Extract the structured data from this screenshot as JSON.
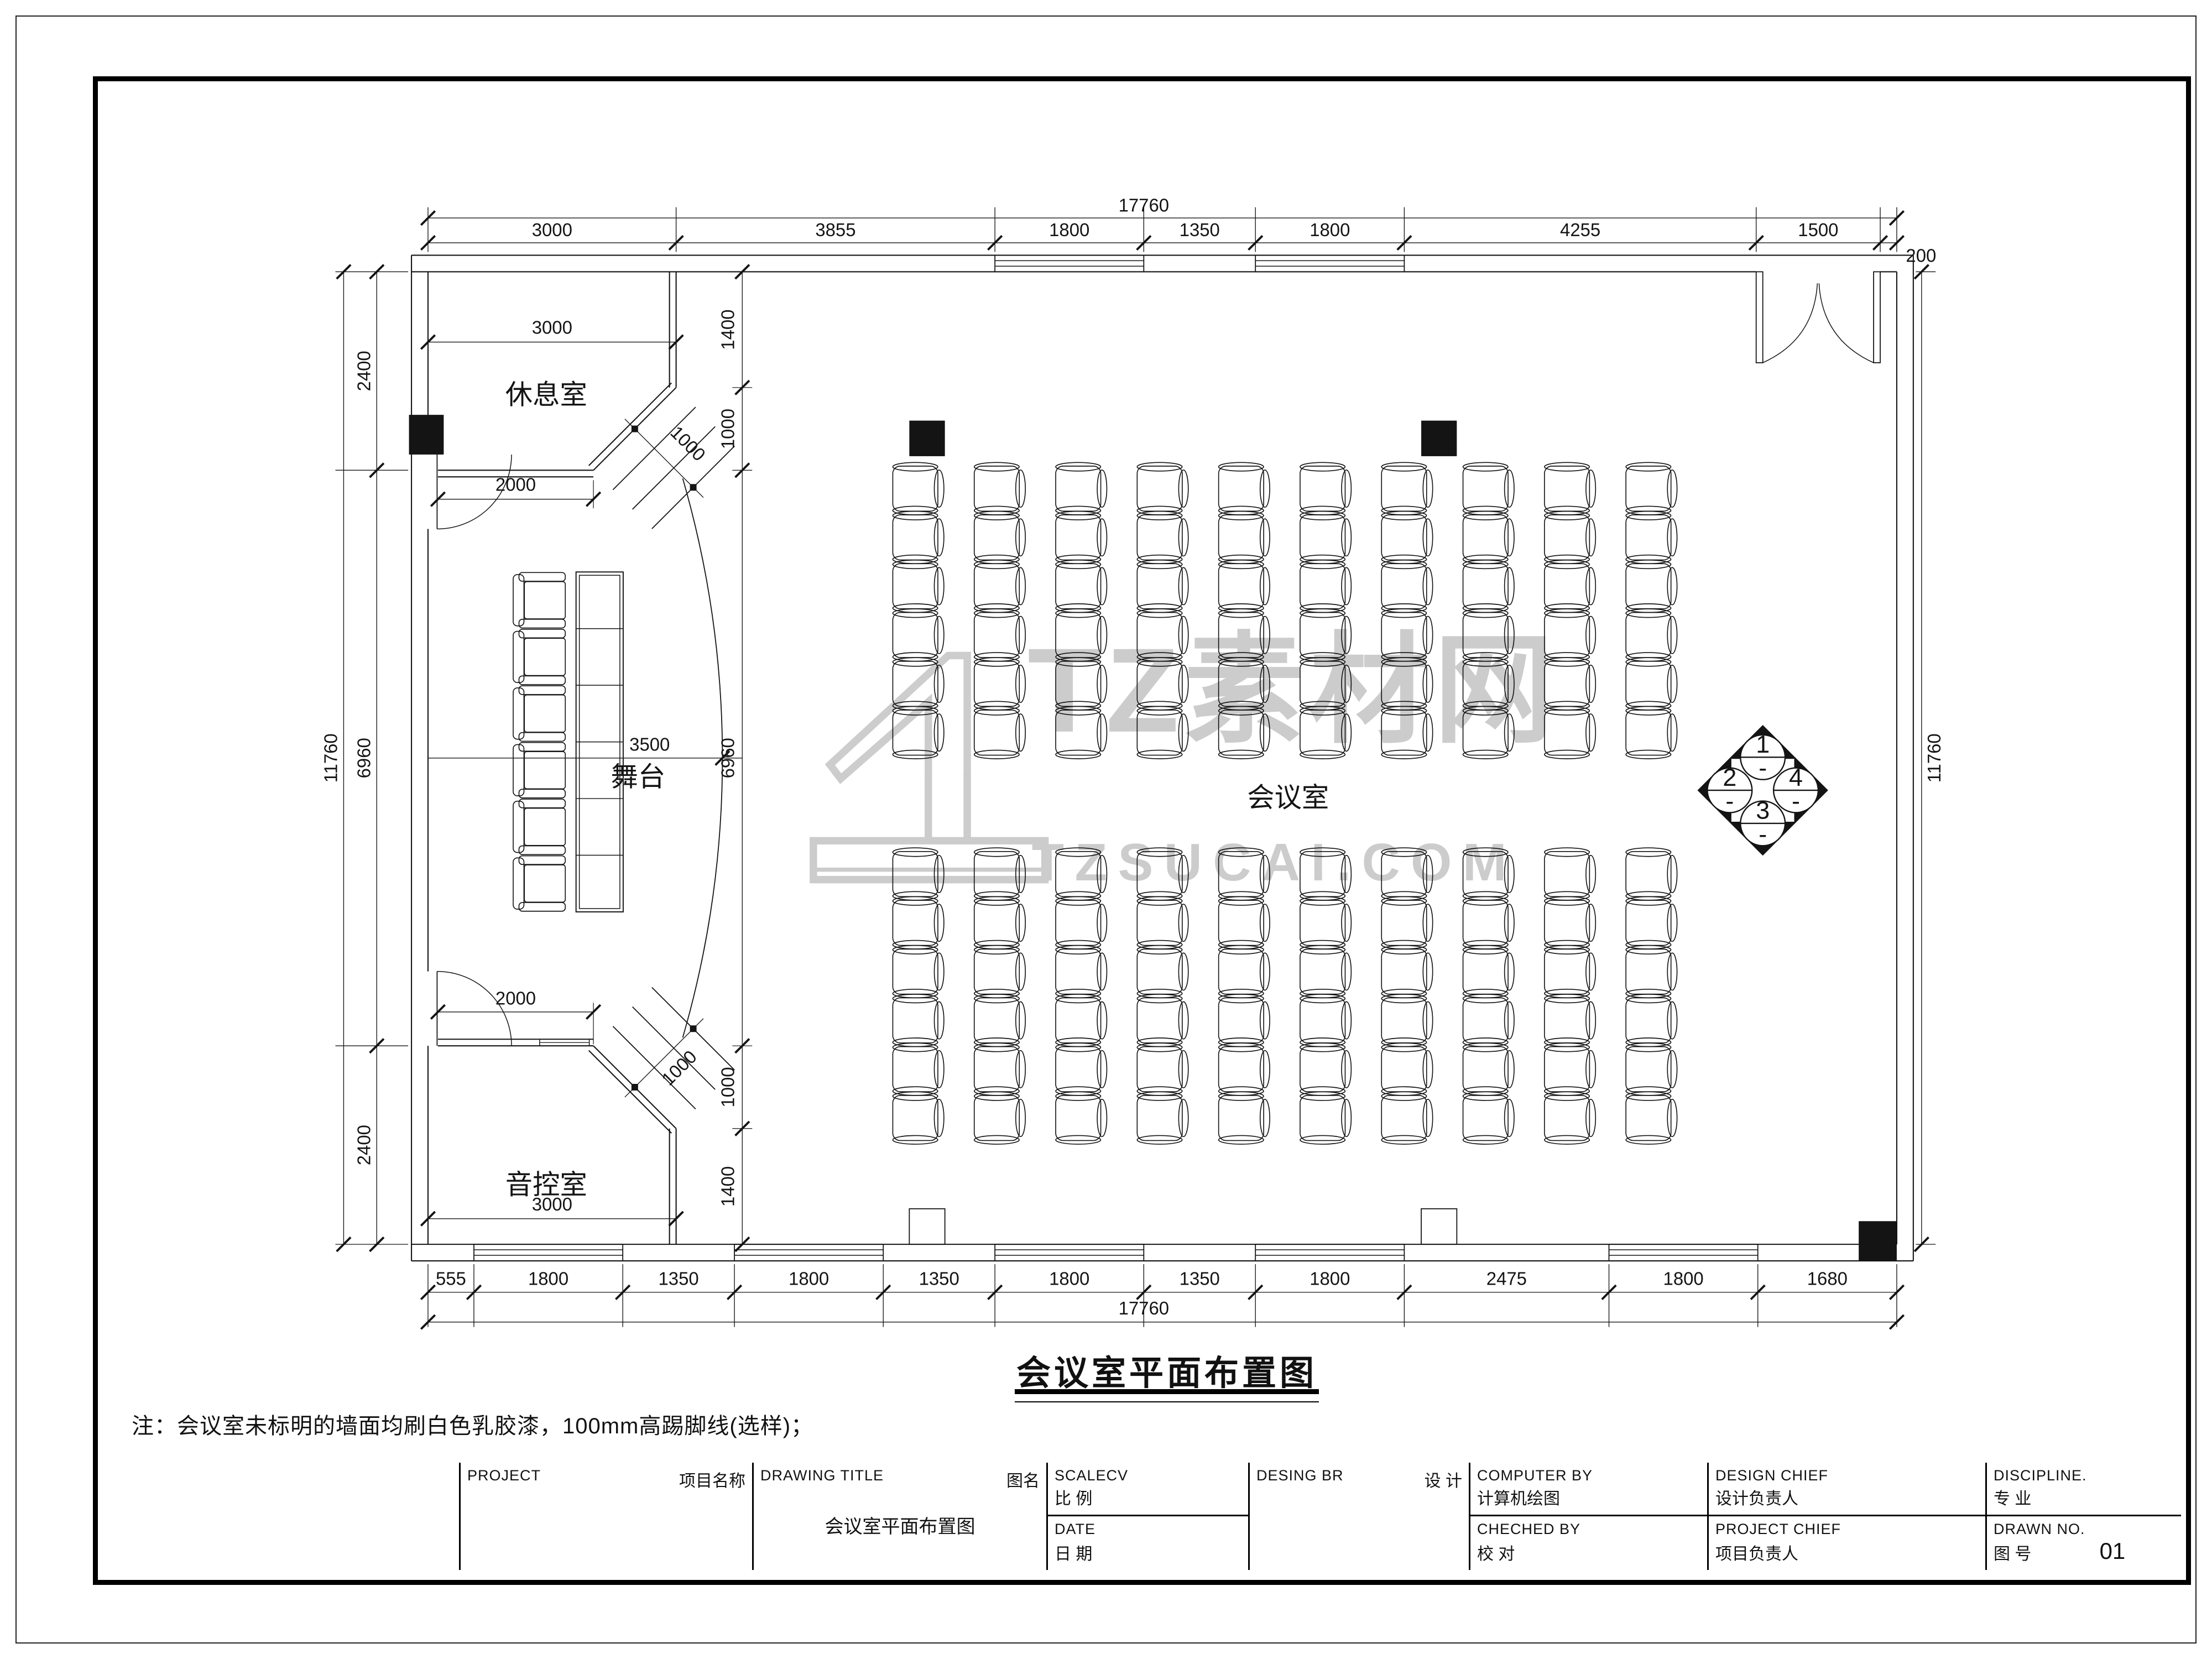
{
  "page": {
    "line_color": "#141414",
    "watermark_color": "#9b9b9b"
  },
  "drawing_title": {
    "text": "会议室平面布置图"
  },
  "note": {
    "text": "注：会议室未标明的墙面均刷白色乳胶漆，100mm高踢脚线(选样)；"
  },
  "watermark": {
    "logo_text": "TZ素材网",
    "url_text": "TZSUCAI.COM"
  },
  "rooms": {
    "lounge": "休息室",
    "stage": "舞台",
    "sound": "音控室",
    "hall": "会议室"
  },
  "marker": {
    "items": [
      "1",
      "2",
      "3",
      "4"
    ],
    "sub": "-"
  },
  "plan": {
    "seat_cols": 10,
    "seat_rows": 6,
    "seat_blocks": 2,
    "stage_chairs": 6
  },
  "dimensions": {
    "top_total": "17760",
    "top_segments": [
      "3000",
      "3855",
      "1800",
      "1350",
      "1800",
      "4255",
      "1500"
    ],
    "top_right_offset": "200",
    "bottom_segments": [
      "555",
      "1800",
      "1350",
      "1800",
      "1350",
      "1800",
      "1350",
      "1800",
      "2475",
      "1800",
      "1680"
    ],
    "bottom_total": "17760",
    "left_segments": [
      "2400",
      "6960",
      "2400"
    ],
    "left_total": "11760",
    "right_total": "11760",
    "inner_chain": [
      "1400",
      "1000",
      "6960",
      "1000",
      "1400"
    ],
    "lounge_width": "3000",
    "lounge_door": "2000",
    "lounge_diag": "1000",
    "sound_door": "2000",
    "sound_width": "3000",
    "sound_diag": "1000",
    "stage_depth": "3500"
  },
  "title_block": {
    "project": {
      "en": "PROJECT",
      "zh": "项目名称"
    },
    "drawing_title": {
      "en": "DRAWING TITLE",
      "zh": "图名",
      "value": "会议室平面布置图"
    },
    "scale": {
      "en": "SCALECV",
      "zh": "比  例"
    },
    "date": {
      "en": "DATE",
      "zh": "日  期"
    },
    "design": {
      "en": "DESING BR",
      "zh": "设  计"
    },
    "computer": {
      "en": "COMPUTER BY",
      "zh": "计算机绘图"
    },
    "checked": {
      "en": "CHECHED BY",
      "zh": "校  对"
    },
    "design_chief": {
      "en": "DESIGN CHIEF",
      "zh": "设计负责人"
    },
    "project_chief": {
      "en": "PROJECT CHIEF",
      "zh": "项目负责人"
    },
    "discipline": {
      "en": "DISCIPLINE.",
      "zh": "专  业"
    },
    "drawn_no": {
      "en": "DRAWN NO.",
      "zh": "图  号",
      "value": "01"
    }
  }
}
